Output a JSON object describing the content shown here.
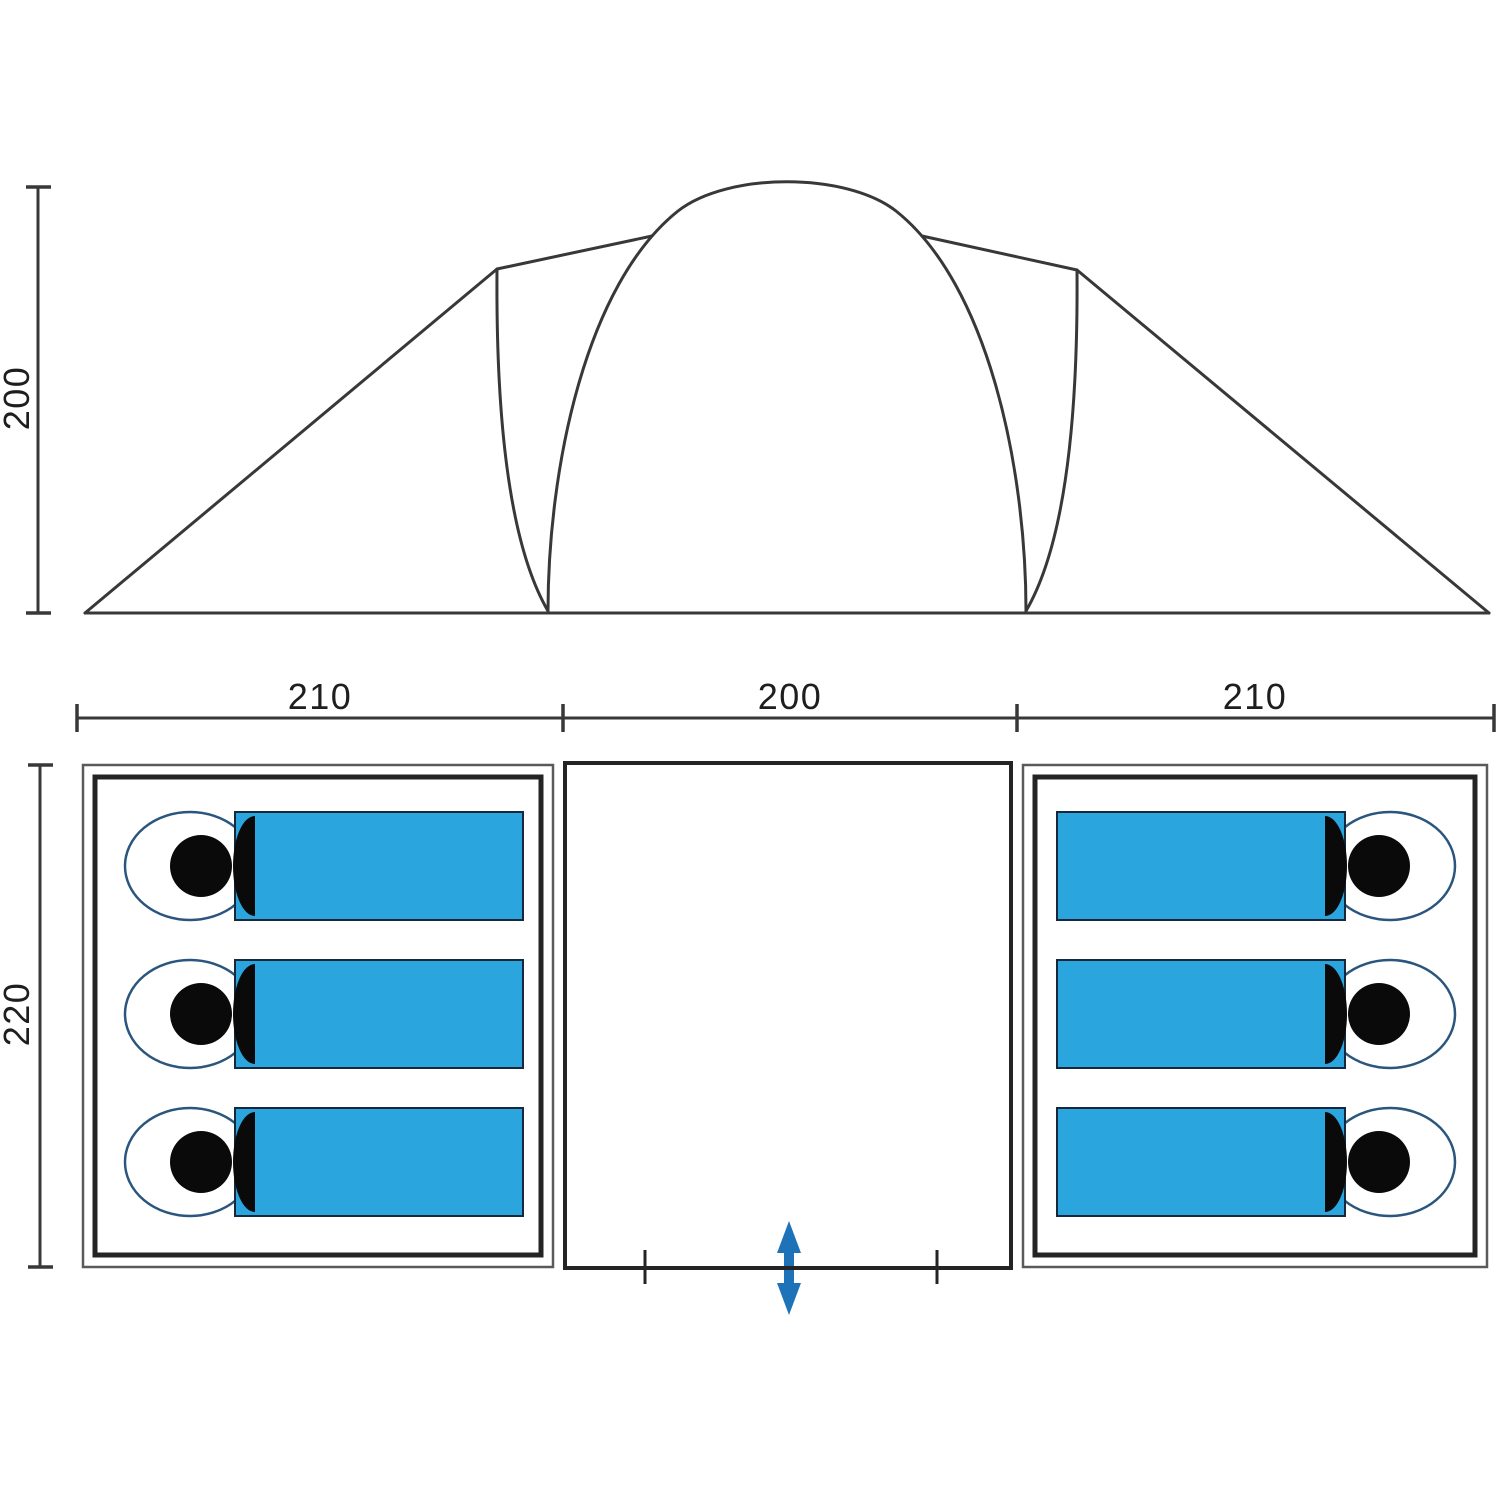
{
  "title": "Tent dimension diagram",
  "dimensions": {
    "elevation_height": "200",
    "plan_widths": [
      "210",
      "200",
      "210"
    ],
    "plan_depth": "220"
  },
  "plan": {
    "sleeping_bags_left": 3,
    "sleeping_bags_right": 3,
    "entrance_icon": "double-vertical-arrow"
  },
  "colors": {
    "sleeping_bag_fill": "#2AA5DE",
    "sleeping_bag_outline": "#2A567E",
    "bag_body_outline": "#16293C",
    "head_fill": "#0A0A0A",
    "entrance_arrow": "#1E73B8",
    "line_dark": "#383838",
    "plan_outer_stroke": "#5A5A5A",
    "plan_inner_stroke": "#242424",
    "text": "#1E1E1E"
  }
}
